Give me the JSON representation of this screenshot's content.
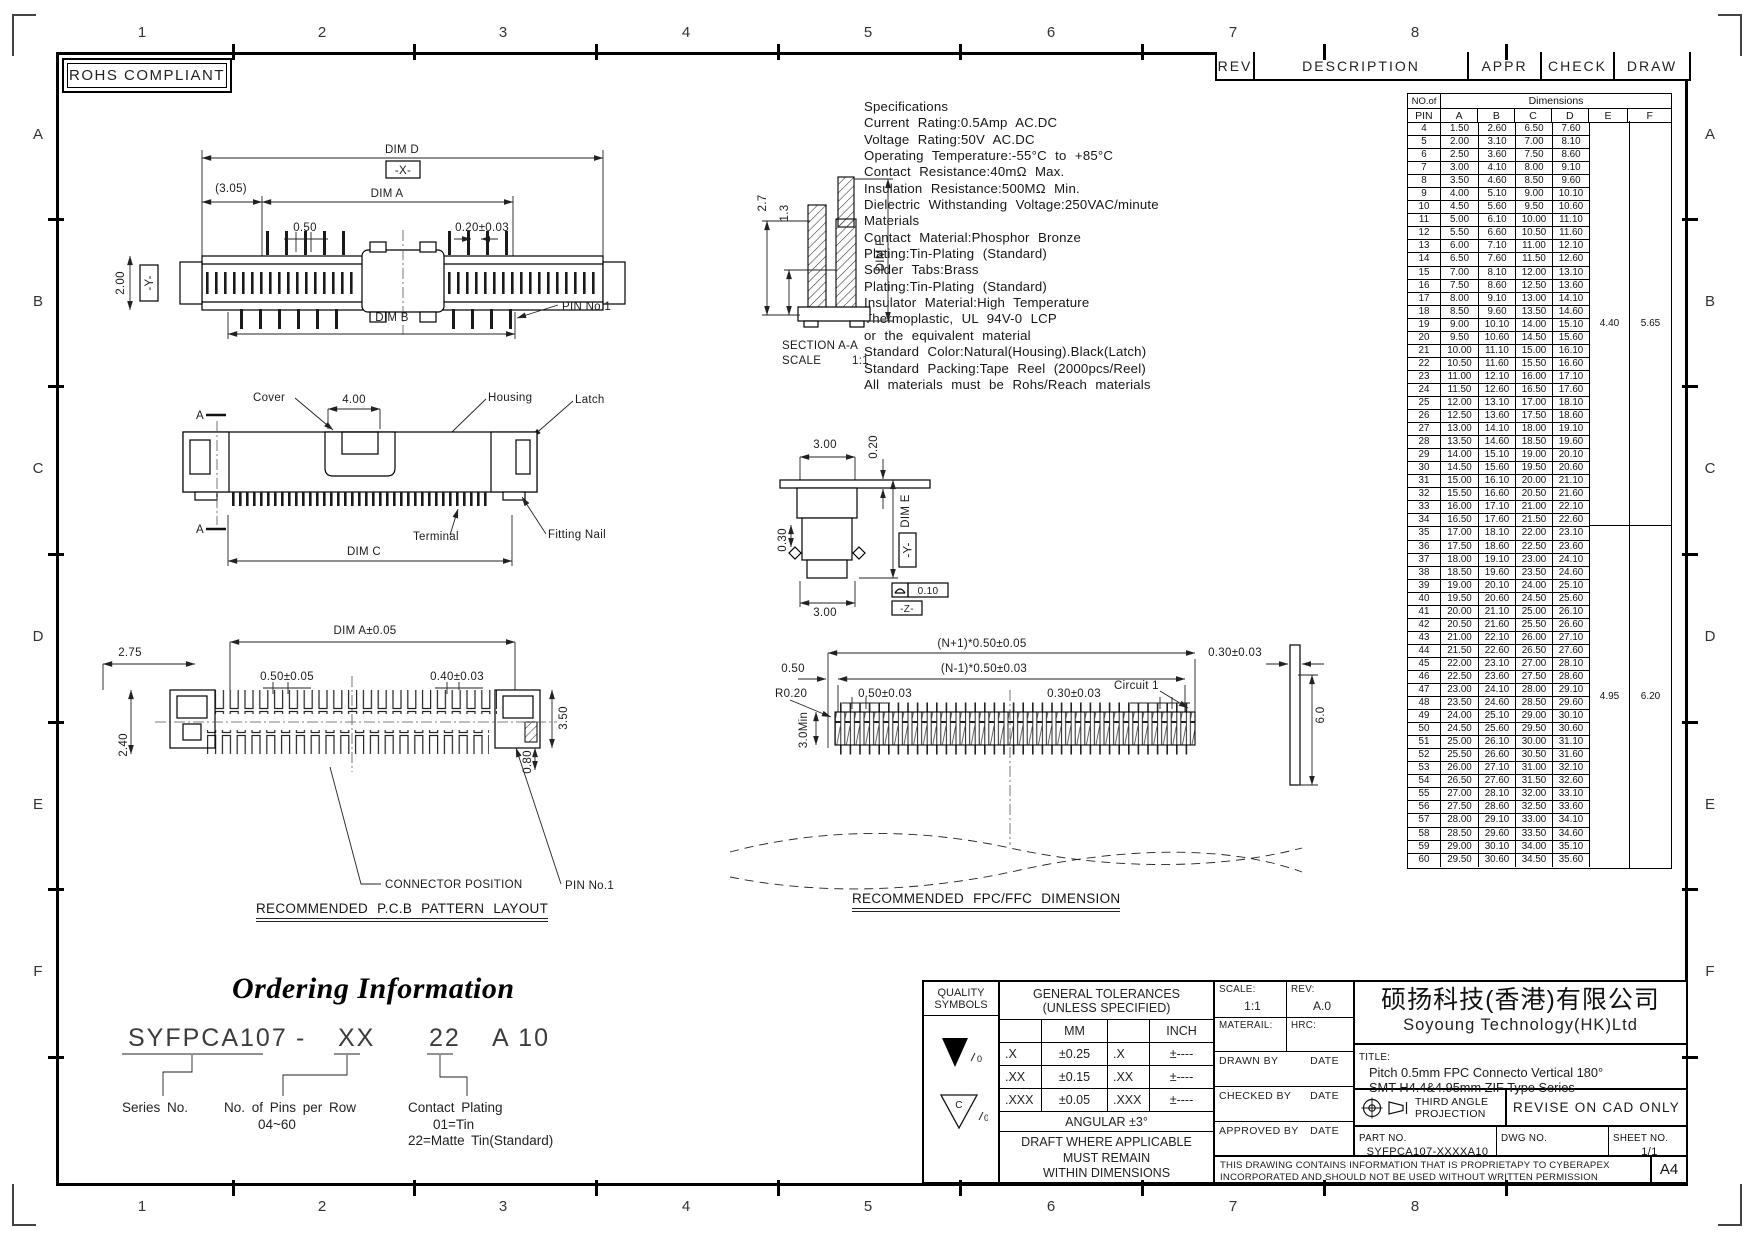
{
  "sheet": {
    "rohs_label": "ROHS COMPLIANT",
    "zone_cols": [
      "1",
      "2",
      "3",
      "4",
      "5",
      "6",
      "7",
      "8"
    ],
    "zone_rows": [
      "A",
      "B",
      "C",
      "D",
      "E",
      "F"
    ]
  },
  "rev_table": {
    "headers": [
      "REV",
      "DESCRIPTION",
      "APPR",
      "CHECK",
      "DRAW"
    ]
  },
  "specifications": [
    "Specifications",
    "Current Rating:0.5Amp AC.DC",
    "Voltage Rating:50V AC.DC",
    "Operating Temperature:-55°C to +85°C",
    "Contact Resistance:40mΩ Max.",
    "Insulation Resistance:500MΩ Min.",
    "Dielectric Withstanding Voltage:250VAC/minute",
    "Materials",
    "Contact Material:Phosphor Bronze",
    "Plating:Tin-Plating (Standard)",
    "Solder Tabs:Brass",
    "Plating:Tin-Plating (Standard)",
    "Insulator Material:High Temperature",
    "Thermoplastic, UL 94V-0 LCP",
    "or the equivalent material",
    "Standard Color:Natural(Housing).Black(Latch)",
    "Standard Packing:Tape Reel (2000pcs/Reel)",
    "All materials must be Rohs/Reach materials"
  ],
  "dim_table": {
    "corner_top": "NO.of",
    "corner_bottom": "PIN",
    "group_header": "Dimensions",
    "columns": [
      "A",
      "B",
      "C",
      "D",
      "E",
      "F"
    ],
    "rows": [
      [
        "4",
        "1.50",
        "2.60",
        "6.50",
        "7.60"
      ],
      [
        "5",
        "2.00",
        "3.10",
        "7.00",
        "8.10"
      ],
      [
        "6",
        "2.50",
        "3.60",
        "7.50",
        "8.60"
      ],
      [
        "7",
        "3.00",
        "4.10",
        "8.00",
        "9.10"
      ],
      [
        "8",
        "3.50",
        "4.60",
        "8.50",
        "9.60"
      ],
      [
        "9",
        "4.00",
        "5.10",
        "9.00",
        "10.10"
      ],
      [
        "10",
        "4.50",
        "5.60",
        "9.50",
        "10.60"
      ],
      [
        "11",
        "5.00",
        "6.10",
        "10.00",
        "11.10"
      ],
      [
        "12",
        "5.50",
        "6.60",
        "10.50",
        "11.60"
      ],
      [
        "13",
        "6.00",
        "7.10",
        "11.00",
        "12.10"
      ],
      [
        "14",
        "6.50",
        "7.60",
        "11.50",
        "12.60"
      ],
      [
        "15",
        "7.00",
        "8.10",
        "12.00",
        "13.10"
      ],
      [
        "16",
        "7.50",
        "8.60",
        "12.50",
        "13.60"
      ],
      [
        "17",
        "8.00",
        "9.10",
        "13.00",
        "14.10"
      ],
      [
        "18",
        "8.50",
        "9.60",
        "13.50",
        "14.60"
      ],
      [
        "19",
        "9.00",
        "10.10",
        "14.00",
        "15.10"
      ],
      [
        "20",
        "9.50",
        "10.60",
        "14.50",
        "15.60"
      ],
      [
        "21",
        "10.00",
        "11.10",
        "15.00",
        "16.10"
      ],
      [
        "22",
        "10.50",
        "11.60",
        "15.50",
        "16.60"
      ],
      [
        "23",
        "11.00",
        "12.10",
        "16.00",
        "17.10"
      ],
      [
        "24",
        "11.50",
        "12.60",
        "16.50",
        "17.60"
      ],
      [
        "25",
        "12.00",
        "13.10",
        "17.00",
        "18.10"
      ],
      [
        "26",
        "12.50",
        "13.60",
        "17.50",
        "18.60"
      ],
      [
        "27",
        "13.00",
        "14.10",
        "18.00",
        "19.10"
      ],
      [
        "28",
        "13.50",
        "14.60",
        "18.50",
        "19.60"
      ],
      [
        "29",
        "14.00",
        "15.10",
        "19.00",
        "20.10"
      ],
      [
        "30",
        "14.50",
        "15.60",
        "19.50",
        "20.60"
      ],
      [
        "31",
        "15.00",
        "16.10",
        "20.00",
        "21.10"
      ],
      [
        "32",
        "15.50",
        "16.60",
        "20.50",
        "21.60"
      ],
      [
        "33",
        "16.00",
        "17.10",
        "21.00",
        "22.10"
      ],
      [
        "34",
        "16.50",
        "17.60",
        "21.50",
        "22.60"
      ],
      [
        "35",
        "17.00",
        "18.10",
        "22.00",
        "23.10"
      ],
      [
        "36",
        "17.50",
        "18.60",
        "22.50",
        "23.60"
      ],
      [
        "37",
        "18.00",
        "19.10",
        "23.00",
        "24.10"
      ],
      [
        "38",
        "18.50",
        "19.60",
        "23.50",
        "24.60"
      ],
      [
        "39",
        "19.00",
        "20.10",
        "24.00",
        "25.10"
      ],
      [
        "40",
        "19.50",
        "20.60",
        "24.50",
        "25.60"
      ],
      [
        "41",
        "20.00",
        "21.10",
        "25.00",
        "26.10"
      ],
      [
        "42",
        "20.50",
        "21.60",
        "25.50",
        "26.60"
      ],
      [
        "43",
        "21.00",
        "22.10",
        "26.00",
        "27.10"
      ],
      [
        "44",
        "21.50",
        "22.60",
        "26.50",
        "27.60"
      ],
      [
        "45",
        "22.00",
        "23.10",
        "27.00",
        "28.10"
      ],
      [
        "46",
        "22.50",
        "23.60",
        "27.50",
        "28.60"
      ],
      [
        "47",
        "23.00",
        "24.10",
        "28.00",
        "29.10"
      ],
      [
        "48",
        "23.50",
        "24.60",
        "28.50",
        "29.60"
      ],
      [
        "49",
        "24.00",
        "25.10",
        "29.00",
        "30.10"
      ],
      [
        "50",
        "24.50",
        "25.60",
        "29.50",
        "30.60"
      ],
      [
        "51",
        "25.00",
        "26.10",
        "30.00",
        "31.10"
      ],
      [
        "52",
        "25.50",
        "26.60",
        "30.50",
        "31.60"
      ],
      [
        "53",
        "26.00",
        "27.10",
        "31.00",
        "32.10"
      ],
      [
        "54",
        "26.50",
        "27.60",
        "31.50",
        "32.60"
      ],
      [
        "55",
        "27.00",
        "28.10",
        "32.00",
        "33.10"
      ],
      [
        "56",
        "27.50",
        "28.60",
        "32.50",
        "33.60"
      ],
      [
        "57",
        "28.00",
        "29.10",
        "33.00",
        "34.10"
      ],
      [
        "58",
        "28.50",
        "29.60",
        "33.50",
        "34.60"
      ],
      [
        "59",
        "29.00",
        "30.10",
        "34.00",
        "35.10"
      ],
      [
        "60",
        "29.50",
        "30.60",
        "34.50",
        "35.60"
      ]
    ],
    "ef_merged": [
      {
        "from": "4",
        "to": "34",
        "e": "4.40",
        "f": "5.65"
      },
      {
        "from": "35",
        "to": "60",
        "e": "4.95",
        "f": "6.20"
      }
    ]
  },
  "drawings": {
    "top_view": {
      "dim_d": "DIM D",
      "x_datum": "-X-",
      "paren_305": "(3.05)",
      "dim_a": "DIM A",
      "pitch_050": "0.50",
      "pin_width": "0.20±0.03",
      "height_200": "2.00",
      "y_datum": "-Y-",
      "dim_b": "DIM B",
      "pin_no1": "PIN No.1"
    },
    "section_aa": {
      "dim_27": "2.7",
      "dim_13": "1.3",
      "dim_f": "DIM F",
      "title": "SECTION A-A",
      "scale_label": "SCALE",
      "scale_value": "1:1"
    },
    "front_view": {
      "cover": "Cover",
      "dim_400": "4.00",
      "housing": "Housing",
      "latch": "Latch",
      "section_a": "A",
      "terminal": "Terminal",
      "fitting_nail": "Fitting Nail",
      "dim_c": "DIM C"
    },
    "side_view": {
      "width_300": "3.00",
      "dim_020": "0.20",
      "dim_030": "0.30",
      "dim_e": "DIM E",
      "y_datum": "-Y-",
      "flatness": "0.10",
      "z_datum": "-Z-",
      "bottom_300": "3.00"
    },
    "pcb_layout": {
      "dim_a": "DIM A±0.05",
      "dim_275": "2.75",
      "dim_050": "0.50±0.05",
      "dim_040": "0.40±0.03",
      "dim_350": "3.50",
      "dim_240": "2.40",
      "dim_080": "0.80",
      "connector_position": "CONNECTOR POSITION",
      "pin_no1": "PIN No.1",
      "title": "RECOMMENDED P.C.B PATTERN LAYOUT"
    },
    "fpc_dim": {
      "len_np1": "(N+1)*0.50±0.05",
      "len_nm1": "(N-1)*0.50±0.03",
      "dim_050": "0.50",
      "r020": "R0.20",
      "dim_050t": "0.50±0.03",
      "dim_030t": "0.30±0.03",
      "circuit_1": "Circuit 1",
      "dim_030r": "0.30±0.03",
      "min_30": "3.0Min",
      "dim_60": "6.0",
      "title": "RECOMMENDED FPC/FFC DIMENSION"
    }
  },
  "ordering": {
    "title": "Ordering Information",
    "code_series": "SYFPCA107",
    "code_dash": "-",
    "code_pins": "XX",
    "code_plating": "22",
    "code_suffix": "A 10",
    "series_label": "Series No.",
    "pins_label": "No. of Pins per Row",
    "pins_range": "04~60",
    "plating_label": "Contact Plating",
    "plating_opt1": "01=Tin",
    "plating_opt2": "22=Matte Tin(Standard)"
  },
  "title_block": {
    "quality_line1": "QUALITY",
    "quality_line2": "SYMBOLS",
    "sym1_zero": "0",
    "sym2_c": "C",
    "sym2_zero": "0",
    "tol_header1": "GENERAL TOLERANCES",
    "tol_header2": "(UNLESS SPECIFIED)",
    "tol_mm": "MM",
    "tol_inch": "INCH",
    "tol_rows": [
      [
        ".X",
        "±0.25",
        ".X",
        "±----"
      ],
      [
        ".XX",
        "±0.15",
        ".XX",
        "±----"
      ],
      [
        ".XXX",
        "±0.05",
        ".XXX",
        "±----"
      ]
    ],
    "tol_angular": "ANGULAR ±3°",
    "tol_note1": "DRAFT WHERE APPLICABLE",
    "tol_note2": "MUST REMAIN",
    "tol_note3": "WITHIN DIMENSIONS",
    "scale_label": "SCALE:",
    "scale_value": "1:1",
    "rev_label": "REV:",
    "rev_value": "A.0",
    "material_label": "MATERAIL:",
    "hrc_label": "HRC:",
    "drawn_label": "DRAWN BY",
    "drawn_date": "DATE",
    "checked_label": "CHECKED BY",
    "checked_date": "DATE",
    "approved_label": "APPROVED BY",
    "approved_date": "DATE",
    "company_cn": "硕扬科技(香港)有限公司",
    "company_en": "Soyoung Technology(HK)Ltd",
    "title_label": "TITLE:",
    "title_line1": "Pitch 0.5mm FPC Connecto Vertical 180°",
    "title_line2": "SMT H4.4&4.95mm ZIF Type Series",
    "projection_label1": "THIRD ANGLE",
    "projection_label2": "PROJECTION",
    "revise_note": "REVISE ON CAD ONLY",
    "part_no_label": "PART NO.",
    "part_no_value": "SYFPCA107-XXXXA10",
    "dwg_no_label": "DWG NO.",
    "sheet_no_label": "SHEET NO.",
    "sheet_no_value": "1/1",
    "proprietary_line1": "THIS DRAWING CONTAINS INFORMATION THAT IS PROPRIETAPY TO CYBERAPEX",
    "proprietary_line2": "INCORPORATED AND SHOULD NOT BE USED WITHOUT WRITTEN PERMISSION",
    "paper_size": "A4"
  }
}
